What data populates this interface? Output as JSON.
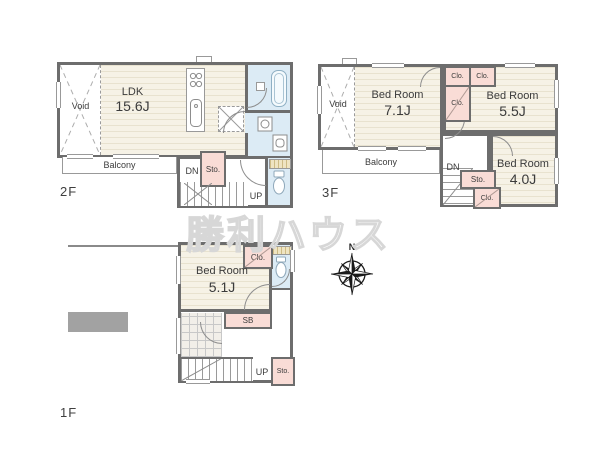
{
  "watermark_text": "勝利ハウス",
  "compass": {
    "north": "N"
  },
  "floor2": {
    "label": "2F",
    "void": "Void",
    "ldk_name": "LDK",
    "ldk_size": "15.6J",
    "balcony": "Balcony",
    "dn": "DN",
    "sto": "Sto.",
    "up": "UP"
  },
  "floor3": {
    "label": "3F",
    "void": "Void",
    "bed1_name": "Bed Room",
    "bed1_size": "7.1J",
    "bed2_name": "Bed Room",
    "bed2_size": "5.5J",
    "bed3_name": "Bed Room",
    "bed3_size": "4.0J",
    "balcony": "Balcony",
    "clo_top_left": "Clo.",
    "clo_top_right": "Clo.",
    "clo_mid": "Clo.",
    "clo_stair": "Clo.",
    "dn": "DN",
    "sto": "Sto."
  },
  "floor1": {
    "label": "1F",
    "bed_name": "Bed Room",
    "bed_size": "5.1J",
    "clo": "Clo.",
    "sb": "SB",
    "up": "UP",
    "sto": "Sto."
  },
  "colors": {
    "wall": "#6d6d6d",
    "floor": "#f6f2e6",
    "closet_pink": "#f9dcd6",
    "wet_area_blue": "#dcebf5",
    "parking_gray": "#a2a2a2"
  }
}
